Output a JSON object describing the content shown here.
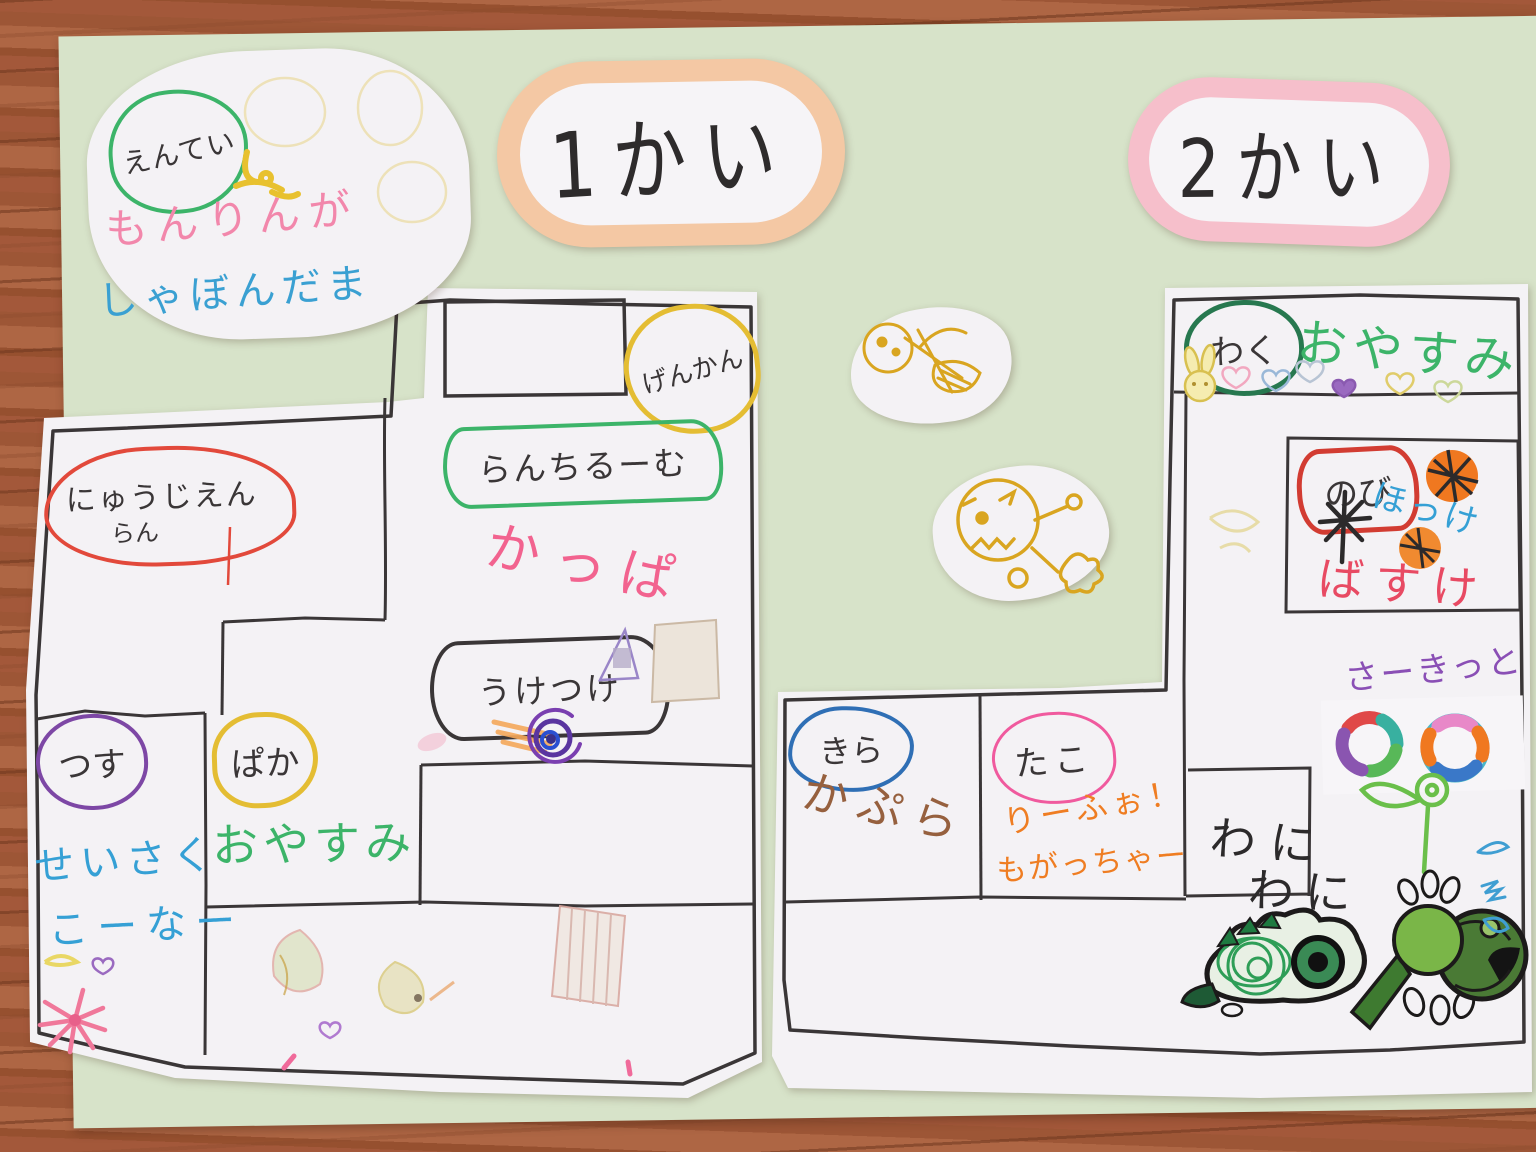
{
  "scene": {
    "description": "Children's hand-drawn floor map poster of a kindergarten (1st and 2nd floor) on green paper, photographed on a wooden table"
  },
  "titles": {
    "floor1": "1かい",
    "floor2": "2かい"
  },
  "entrance": {
    "badge": "えんてい",
    "pink_line": "もんりんが",
    "blue_line": "しゃぼんだま"
  },
  "floor1_rooms": {
    "genkan": "げんかん",
    "lunchroom": "らんちるーむ",
    "kappa": "かっぱ",
    "nyuujien": "にゅうじえん",
    "nyuujien_sub": "らん",
    "uketsuke": "うけつけ",
    "tsusu": "つす",
    "paka": "ぱか",
    "oyasumi": "おやすみ",
    "seisaku_line1": "せいさく",
    "seisaku_line2": "こーなー"
  },
  "floor2_rooms": {
    "waku": "わく",
    "oyasumi": "おやすみ",
    "nobi": "のび",
    "hokke": "ほっけ",
    "basuke": "ばすけ",
    "circuit": "さーきっと",
    "kira": "きら",
    "kapura": "かぷら",
    "tako": "たこ",
    "riifo": "りーふぉ！",
    "mogatcha": "もがっちゃー",
    "wani_top": "わに",
    "wani_bottom": "わに"
  },
  "doodles": {
    "yellow_figures": "two yellow marker child drawings on white cutouts",
    "hearts_row": "bunny face and colored hearts",
    "basketballs": "orange balls with black lines",
    "rings": "two multicolored rings",
    "crocodiles": "two green crocodile drawings",
    "spiral": "purple-blue spiral",
    "flower": "pink flower burst and green flower"
  },
  "colors": {
    "wood": "#9d5636",
    "poster_green": "#d7e3c9",
    "paper_white": "#f4f2f5",
    "plaque1_border": "#f4c8a4",
    "plaque2_border": "#f6bfcb",
    "marker_black": "#3a3637",
    "marker_red": "#e2493b",
    "marker_pink": "#f2638f",
    "marker_blue": "#35a0d5",
    "marker_green": "#3cb469",
    "marker_dark_green": "#27784f",
    "marker_yellow": "#e4bd33",
    "marker_purple": "#7d47a5",
    "marker_orange": "#ef7d22",
    "marker_brown": "#96603e"
  }
}
